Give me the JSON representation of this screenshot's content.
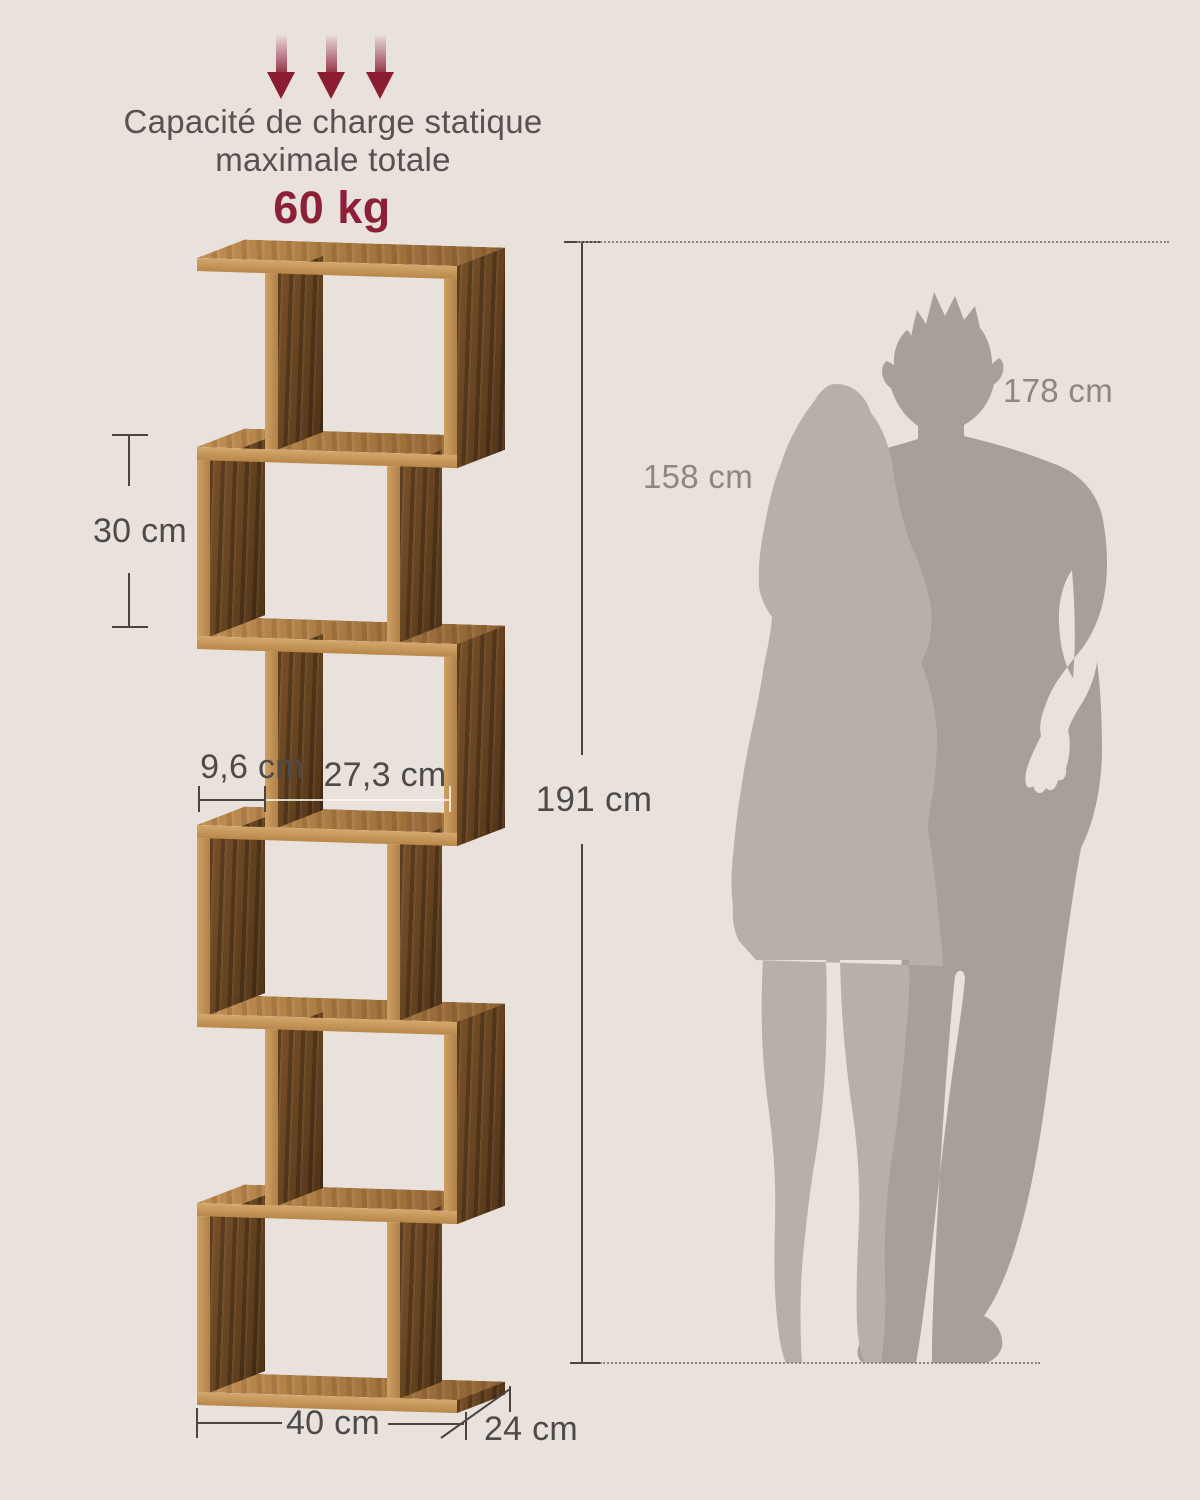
{
  "colors": {
    "background": "#e9e1db",
    "accent_red": "#8b1d33",
    "text_dark": "#4e4a48",
    "text_gray": "#8d8683",
    "wood_light": "#c9985e",
    "wood_dark": "#5f3e1e",
    "silhouette_man": "#a89f9b",
    "silhouette_woman": "#b8afab"
  },
  "load_capacity": {
    "arrow_icon": "down-arrow",
    "arrow_count": 3,
    "line1": "Capacité de charge statique",
    "line2": "maximale totale",
    "value": "60 kg"
  },
  "dimensions": {
    "tier_height": "30 cm",
    "notch_width": "9,6 cm",
    "inner_width": "27,3 cm",
    "total_height": "191 cm",
    "width": "40 cm",
    "depth": "24 cm"
  },
  "figures": {
    "woman_height": "158 cm",
    "man_height": "178 cm"
  },
  "shelf": {
    "tier_count": 6,
    "style": "zigzag-cube-bookshelf"
  }
}
